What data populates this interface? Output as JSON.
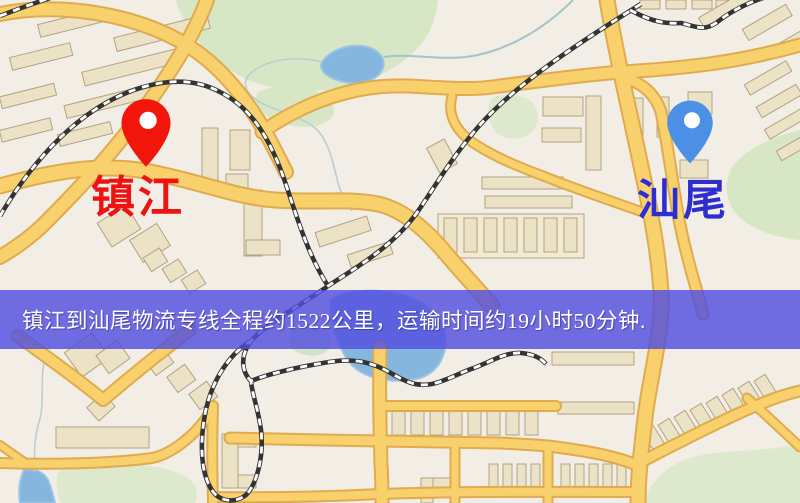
{
  "banner": {
    "text": "镇江到汕尾物流专线全程约1522公里，运输时间约19小时50分钟.",
    "bg": "rgba(82,78,223,0.82)",
    "text_color": "#ffffff"
  },
  "markers": [
    {
      "id": "zhenjiang",
      "label": "镇江",
      "pin_color": "#f2150c",
      "pin_edge": "#c90f08",
      "label_color": "#ee1212",
      "pin_tip_x": 146,
      "pin_tip_y": 168
    },
    {
      "id": "shanwei",
      "label": "汕尾",
      "pin_color": "#4b90e4",
      "pin_edge": "#3a7ed2",
      "label_color": "#2e2ecf",
      "pin_tip_x": 690,
      "pin_tip_y": 166
    }
  ],
  "map_palette": {
    "land": "#f2eee6",
    "road_fill": "#f8d06c",
    "road_casing": "#dfab4f",
    "park_green": "#d7e7c5",
    "water_blue": "#85b6de",
    "building_fill": "#ece3c6",
    "railway_dark": "#333333"
  }
}
